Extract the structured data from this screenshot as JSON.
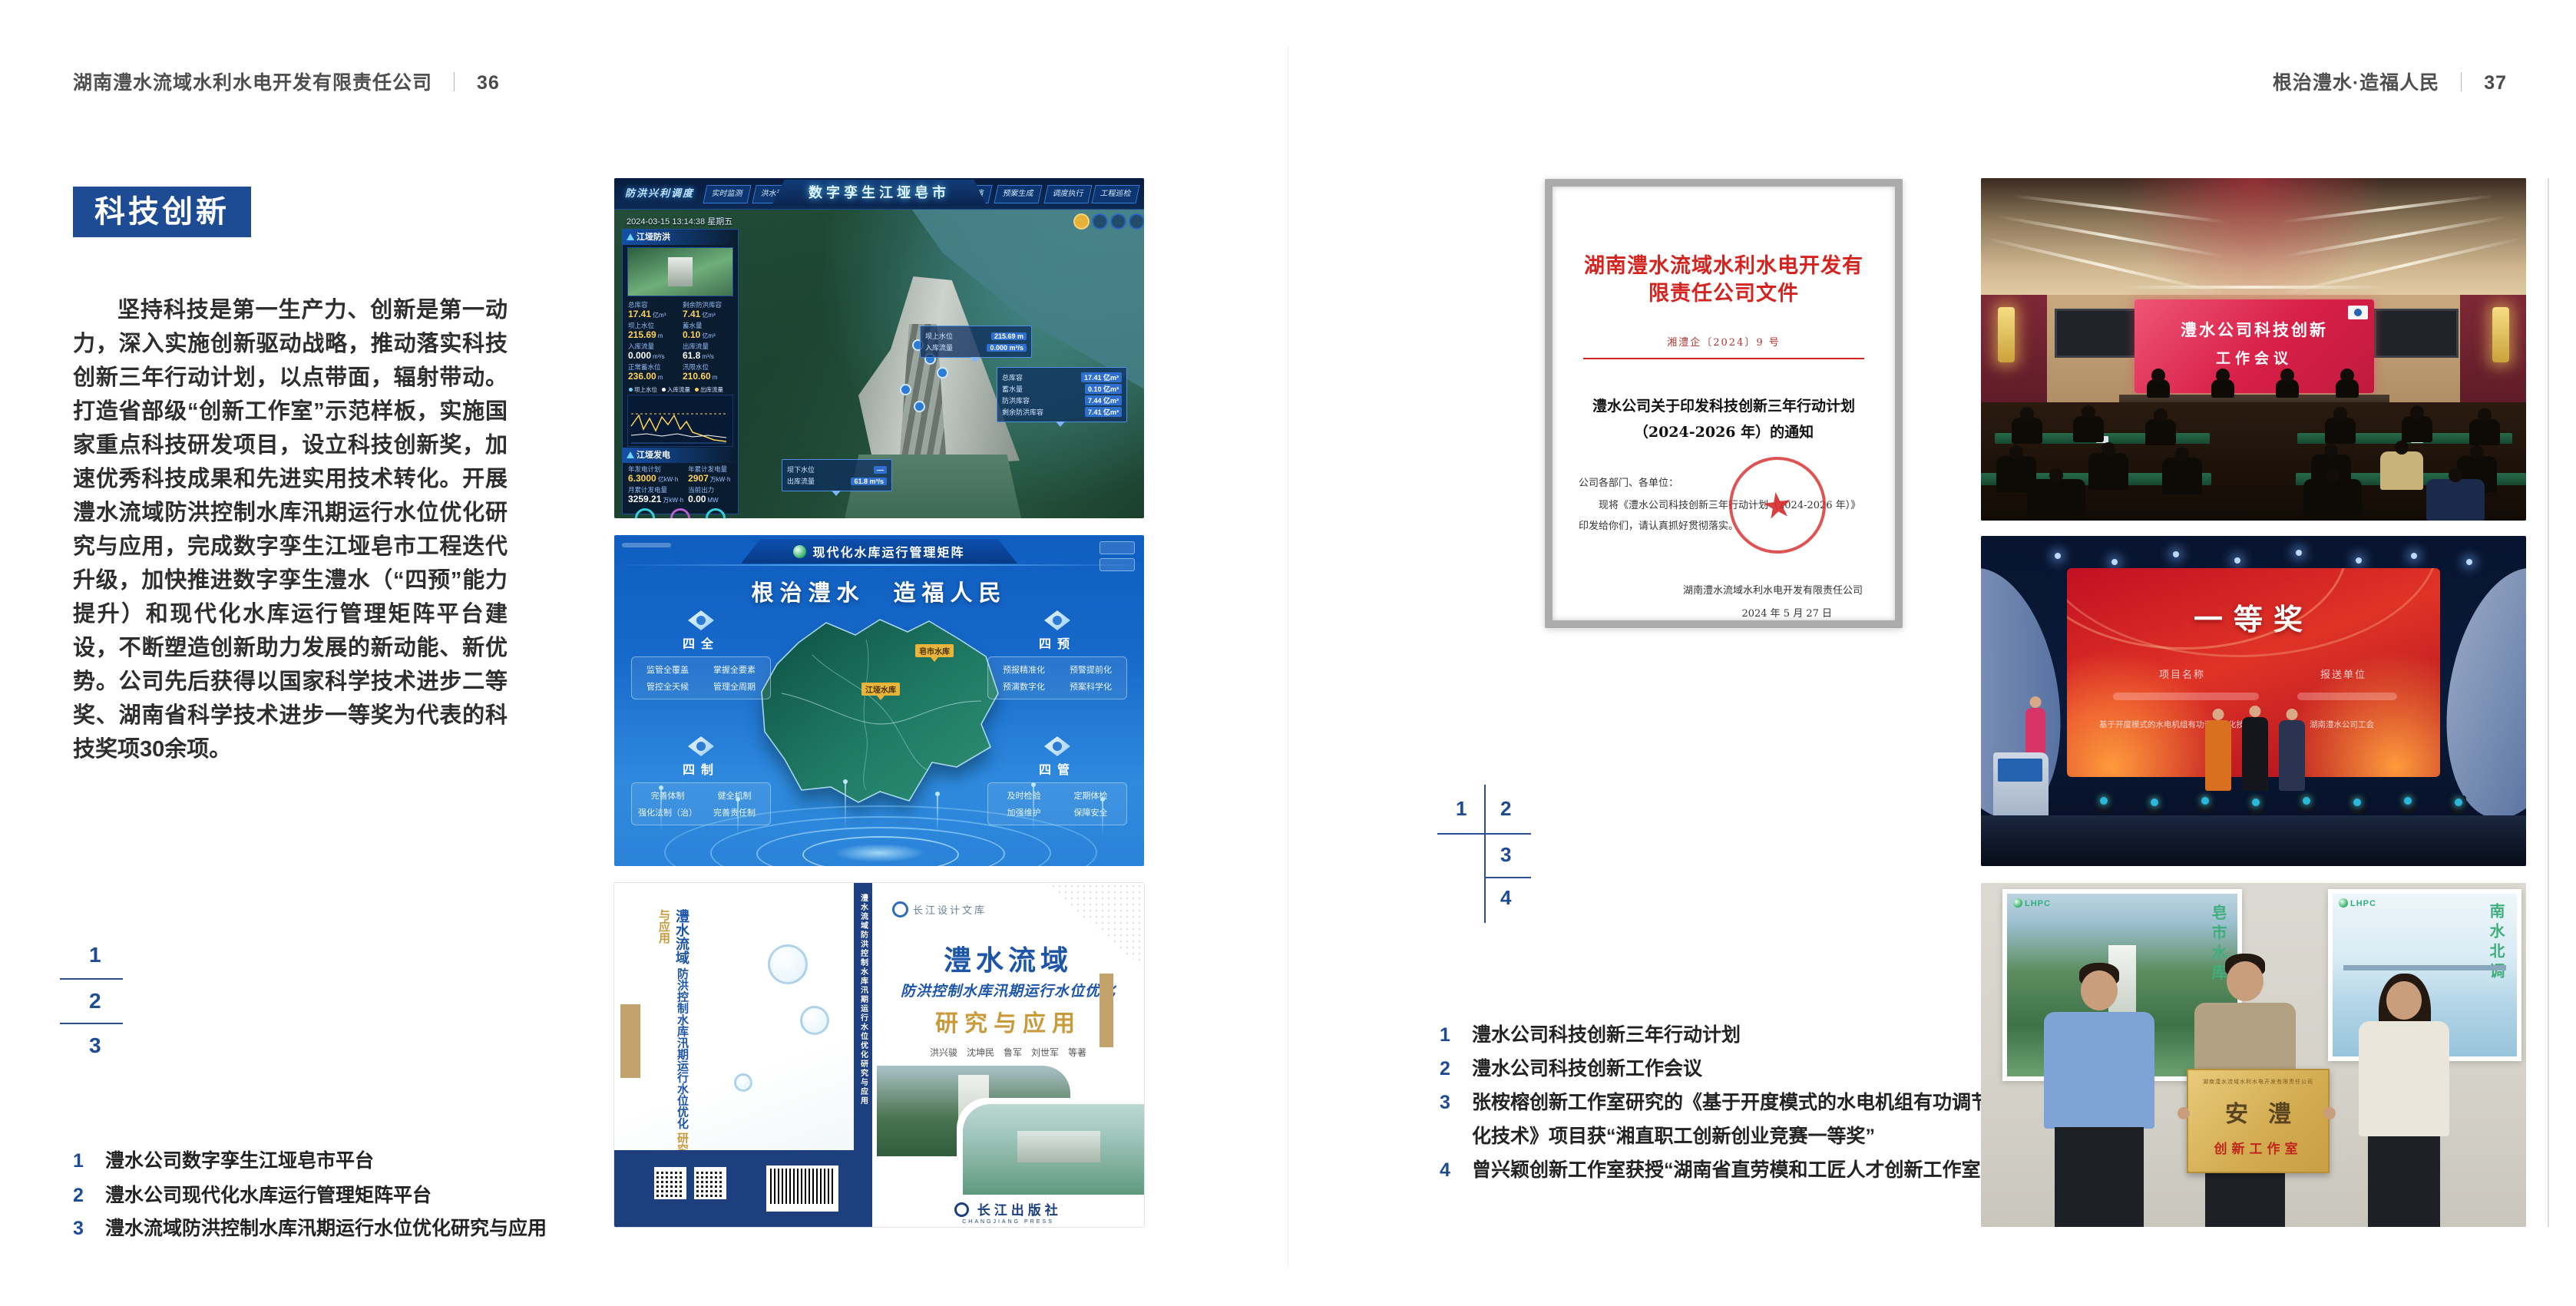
{
  "page_left": {
    "header": {
      "company": "湖南澧水流域水利水电开发有限责任公司",
      "sep": "｜",
      "page": "36"
    },
    "section_title": "科技创新",
    "body": "坚持科技是第一生产力、创新是第一动力，深入实施创新驱动战略，推动落实科技创新三年行动计划，以点带面，辐射带动。打造省部级“创新工作室”示范样板，实施国家重点科技研发项目，设立科技创新奖，加速优秀科技成果和先进实用技术转化。开展澧水流域防洪控制水库汛期运行水位优化研究与应用，完成数字孪生江垭皂市工程迭代升级，加快推进数字孪生澧水（“四预”能力提升）和现代化水库运行管理矩阵平台建设，不断塑造创新助力发展的新动能、新优势。公司先后获得以国家科学技术进步二等奖、湖南省科学技术进步一等奖为代表的科技奖项30余项。",
    "figure_nums": [
      "1",
      "2",
      "3"
    ],
    "captions": [
      {
        "num": "1",
        "text": "澧水公司数字孪生江垭皂市平台"
      },
      {
        "num": "2",
        "text": "澧水公司现代化水库运行管理矩阵平台"
      },
      {
        "num": "3",
        "text": "澧水流域防洪控制水库汛期运行水位优化研究与应用"
      }
    ]
  },
  "page_right": {
    "header": {
      "slogan": "根治澧水·造福人民",
      "sep": "｜",
      "page": "37"
    },
    "figure_nums": [
      "1",
      "2",
      "3",
      "4"
    ],
    "captions": [
      {
        "num": "1",
        "text": "澧水公司科技创新三年行动计划"
      },
      {
        "num": "2",
        "text": "澧水公司科技创新工作会议"
      },
      {
        "num": "3",
        "text": "张桉榕创新工作室研究的《基于开度模式的水电机组有功调节优化技术》项目获“湘直职工创新创业竞赛一等奖”"
      },
      {
        "num": "4",
        "text": "曾兴颖创新工作室获授“湖南省直劳模和工匠人才创新工作室”"
      }
    ]
  },
  "dashboard": {
    "nav_label": "防洪兴利调度",
    "title": "数字孪生江垭皂市",
    "tabs_left": [
      "实时监测",
      "洪水预报",
      "防洪预警"
    ],
    "tabs_right": [
      "防洪预演",
      "预案生成",
      "调度执行",
      "工程巡检"
    ],
    "datetime": "2024-03-15 13:14:38 星期五",
    "panel_flood": {
      "title": "江垭防洪",
      "metrics": [
        {
          "label": "总库容",
          "value": "17.41",
          "unit": "亿m³"
        },
        {
          "label": "剩余防洪库容",
          "value": "7.41",
          "unit": "亿m³"
        },
        {
          "label": "坝上水位",
          "value": "215.69",
          "unit": "m"
        },
        {
          "label": "蓄水量",
          "value": "0.10",
          "unit": "亿m³"
        },
        {
          "label": "入库流量",
          "value": "0.000",
          "unit": "m³/s"
        },
        {
          "label": "出库流量",
          "value": "61.8",
          "unit": "m³/s"
        },
        {
          "label": "正常蓄水位",
          "value": "236.00",
          "unit": "m"
        },
        {
          "label": "汛限水位",
          "value": "210.60",
          "unit": "m"
        }
      ],
      "legend": [
        "坝上水位",
        "入库流量",
        "出库流量"
      ]
    },
    "panel_power": {
      "title": "江垭发电",
      "metrics": [
        {
          "label": "年发电计划",
          "value": "6.3000",
          "unit": "亿kW·h"
        },
        {
          "label": "年累计发电量",
          "value": "2907",
          "unit": "万kW·h"
        },
        {
          "label": "月累计发电量",
          "value": "3259.21",
          "unit": "万kW·h"
        },
        {
          "label": "当前出力",
          "value": "0.00",
          "unit": "MW"
        }
      ],
      "units": [
        "1#机组",
        "2#机组",
        "3#机组"
      ]
    },
    "callout_up": {
      "rows": [
        {
          "label": "坝上水位",
          "value": "215.69 m"
        },
        {
          "label": "入库流量",
          "value": "0.000 m³/s"
        }
      ]
    },
    "callout_storage": {
      "rows": [
        {
          "label": "总库容",
          "value": "17.41 亿m³"
        },
        {
          "label": "蓄水量",
          "value": "0.10 亿m³"
        },
        {
          "label": "防洪库容",
          "value": "7.44 亿m³"
        },
        {
          "label": "剩余防洪库容",
          "value": "7.41 亿m³"
        }
      ]
    },
    "callout_down": {
      "rows": [
        {
          "label": "坝下水位",
          "value": "—"
        },
        {
          "label": "出库流量",
          "value": "61.8 m³/s"
        }
      ]
    }
  },
  "matrix": {
    "header_title": "现代化水库运行管理矩阵",
    "slogan": "根治澧水　造福人民",
    "panels": [
      {
        "title": "四全",
        "items": [
          "监管全覆盖",
          "掌握全要素",
          "管控全天候",
          "管理全周期"
        ]
      },
      {
        "title": "四预",
        "items": [
          "预报精准化",
          "预警提前化",
          "预演数字化",
          "预案科学化"
        ]
      },
      {
        "title": "四制",
        "items": [
          "完善体制",
          "健全机制",
          "强化法制（治）",
          "完善责任制"
        ]
      },
      {
        "title": "四管",
        "items": [
          "及时检验",
          "定期体检",
          "加强维护",
          "保障安全"
        ]
      }
    ],
    "map_tags": [
      "皂市水库",
      "江垭水库"
    ]
  },
  "book": {
    "series": "长江设计文库",
    "title1": "澧水流域",
    "title2": "防洪控制水库汛期运行水位优化",
    "title3": "研究与应用",
    "authors": "洪兴骏　沈坤民　鲁军　刘世军　等著",
    "spine": "澧水流域防洪控制水库汛期运行水位优化研究与应用",
    "publisher": "长江出版社",
    "publisher_en": "CHANGJIANG PRESS"
  },
  "document": {
    "header": "湖南澧水流域水利水电开发有限责任公司文件",
    "doc_no": "湘澧企〔2024〕9 号",
    "title1": "澧水公司关于印发科技创新三年行动计划",
    "title2": "（2024-2026 年）的通知",
    "salutation": "公司各部门、各单位：",
    "body": "现将《澧水公司科技创新三年行动计划（2024-2026 年）》印发给你们，请认真抓好贯彻落实。",
    "signer": "湖南澧水流域水利水电开发有限责任公司",
    "date": "2024 年 5 月 27 日",
    "seal_star": "★"
  },
  "meeting": {
    "screen_line1": "澧水公司科技创新",
    "screen_line2": "工作会议"
  },
  "award": {
    "screen_title": "一等奖",
    "col1": "项目名称",
    "col2": "报送单位",
    "row_name": "基于开度模式的水电机组有功调节优化技术",
    "row_unit": "湖南澧水公司工会"
  },
  "plaque": {
    "header": "湖南澧水流域水利水电开发有限责任公司",
    "main": "安澧",
    "sub": "创新工作室",
    "poster_left_logo": "LHPC",
    "poster_right_logo": "LHPC",
    "poster_left_text": "皂市水库",
    "poster_right_text": "南水北调"
  }
}
